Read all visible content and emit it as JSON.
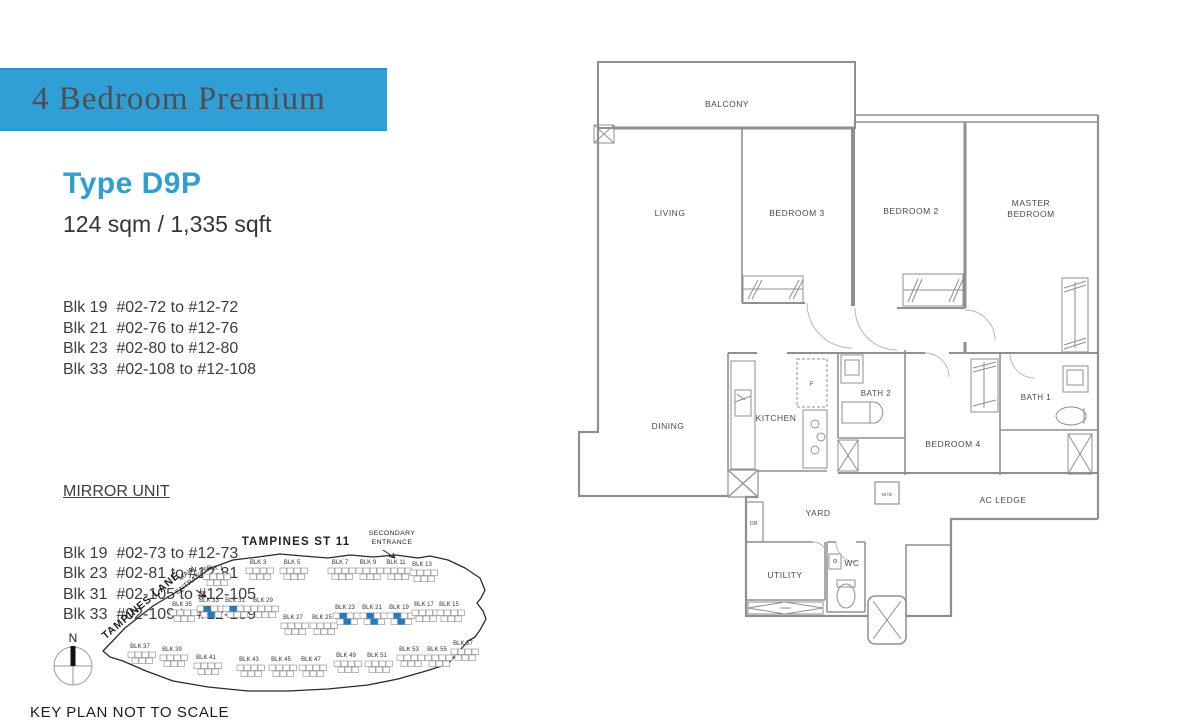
{
  "banner": {
    "title": "4 Bedroom Premium",
    "bg": "#2f9fd6",
    "text_color": "#4b5057"
  },
  "unit": {
    "type_label": "Type D9P",
    "accent": "#2e9ed3",
    "area": "124 sqm / 1,335 sqft",
    "blocks": [
      "Blk 19  #02-72 to #12-72",
      "Blk 21  #02-76 to #12-76",
      "Blk 23  #02-80 to #12-80",
      "Blk 33  #02-108 to #12-108"
    ],
    "mirror_title": "MIRROR UNIT",
    "mirror_blocks": [
      "Blk 19  #02-73 to #12-73",
      "Blk 23  #02-81 to #12-81",
      "Blk 31  #02-105 to #12-105",
      "Blk 33  #02-109 to #12-109"
    ]
  },
  "floorplan": {
    "rooms": [
      {
        "t": "BALCONY",
        "x": 162,
        "y": 57,
        "s": 8.5
      },
      {
        "t": "LIVING",
        "x": 105,
        "y": 166,
        "s": 8.5
      },
      {
        "t": "BEDROOM 3",
        "x": 232,
        "y": 166,
        "s": 8.5
      },
      {
        "t": "BEDROOM 2",
        "x": 346,
        "y": 164,
        "s": 8.5
      },
      {
        "t": "MASTER",
        "x": 466,
        "y": 156,
        "s": 8.5
      },
      {
        "t": "BEDROOM",
        "x": 466,
        "y": 167,
        "s": 8.5
      },
      {
        "t": "DINING",
        "x": 103,
        "y": 379,
        "s": 8.5
      },
      {
        "t": "KITCHEN",
        "x": 211,
        "y": 371,
        "s": 8.5
      },
      {
        "t": "F",
        "x": 247,
        "y": 336,
        "s": 6
      },
      {
        "t": "BATH 2",
        "x": 311,
        "y": 346,
        "s": 8
      },
      {
        "t": "BEDROOM 4",
        "x": 388,
        "y": 397,
        "s": 8.5
      },
      {
        "t": "BATH 1",
        "x": 471,
        "y": 350,
        "s": 8
      },
      {
        "t": "YARD",
        "x": 253,
        "y": 466,
        "s": 8.5
      },
      {
        "t": "W/D",
        "x": 322,
        "y": 446,
        "s": 4.8
      },
      {
        "t": "AC LEDGE",
        "x": 438,
        "y": 453,
        "s": 8.5
      },
      {
        "t": "DB",
        "x": 189,
        "y": 475,
        "s": 5
      },
      {
        "t": "UTILITY",
        "x": 220,
        "y": 528,
        "s": 8.5
      },
      {
        "t": "WC",
        "x": 287,
        "y": 516,
        "s": 8.5
      }
    ]
  },
  "keyplan": {
    "street": "TAMPINES ST 11",
    "secondary_entrance_1": "SECONDARY",
    "secondary_entrance_2": "ENTRANCE",
    "main_entrance_1": "MAIN",
    "main_entrance_2": "ENTRANCE",
    "lane": "TAMPINES LANE",
    "north": "N",
    "caption": "KEY PLAN NOT TO SCALE",
    "highlight_color": "#2878bf",
    "blocks": [
      {
        "label": "BLK 1",
        "x": 187,
        "y": 52,
        "hl": []
      },
      {
        "label": "BLK 3",
        "x": 230,
        "y": 46,
        "hl": []
      },
      {
        "label": "BLK 5",
        "x": 264,
        "y": 46,
        "hl": []
      },
      {
        "label": "BLK 7",
        "x": 312,
        "y": 46,
        "hl": []
      },
      {
        "label": "BLK 9",
        "x": 340,
        "y": 46,
        "hl": []
      },
      {
        "label": "BLK 11",
        "x": 368,
        "y": 46,
        "hl": []
      },
      {
        "label": "BLK 13",
        "x": 394,
        "y": 48,
        "hl": []
      },
      {
        "label": "BLK 35",
        "x": 154,
        "y": 88,
        "hl": []
      },
      {
        "label": "BLK 33",
        "x": 181,
        "y": 84,
        "hl": [
          1,
          5
        ]
      },
      {
        "label": "BLK 31",
        "x": 207,
        "y": 84,
        "hl": [
          1
        ]
      },
      {
        "label": "BLK 29",
        "x": 235,
        "y": 84,
        "hl": []
      },
      {
        "label": "BLK 27",
        "x": 265,
        "y": 101,
        "hl": []
      },
      {
        "label": "BLK 25",
        "x": 294,
        "y": 101,
        "hl": []
      },
      {
        "label": "BLK 23",
        "x": 317,
        "y": 91,
        "hl": [
          1,
          5
        ]
      },
      {
        "label": "BLK 21",
        "x": 344,
        "y": 91,
        "hl": [
          1,
          5
        ]
      },
      {
        "label": "BLK 19",
        "x": 371,
        "y": 91,
        "hl": [
          1,
          5
        ]
      },
      {
        "label": "BLK 17",
        "x": 396,
        "y": 88,
        "hl": []
      },
      {
        "label": "BLK 15",
        "x": 421,
        "y": 88,
        "hl": []
      },
      {
        "label": "BLK 37",
        "x": 112,
        "y": 130,
        "hl": []
      },
      {
        "label": "BLK 39",
        "x": 144,
        "y": 133,
        "hl": []
      },
      {
        "label": "BLK 41",
        "x": 178,
        "y": 141,
        "hl": []
      },
      {
        "label": "BLK 43",
        "x": 221,
        "y": 143,
        "hl": []
      },
      {
        "label": "BLK 45",
        "x": 253,
        "y": 143,
        "hl": []
      },
      {
        "label": "BLK 47",
        "x": 283,
        "y": 143,
        "hl": []
      },
      {
        "label": "BLK 49",
        "x": 318,
        "y": 139,
        "hl": []
      },
      {
        "label": "BLK 51",
        "x": 349,
        "y": 139,
        "hl": []
      },
      {
        "label": "BLK 53",
        "x": 381,
        "y": 133,
        "hl": []
      },
      {
        "label": "BLK 55",
        "x": 409,
        "y": 133,
        "hl": []
      },
      {
        "label": "BLK 57",
        "x": 435,
        "y": 127,
        "hl": []
      }
    ]
  }
}
